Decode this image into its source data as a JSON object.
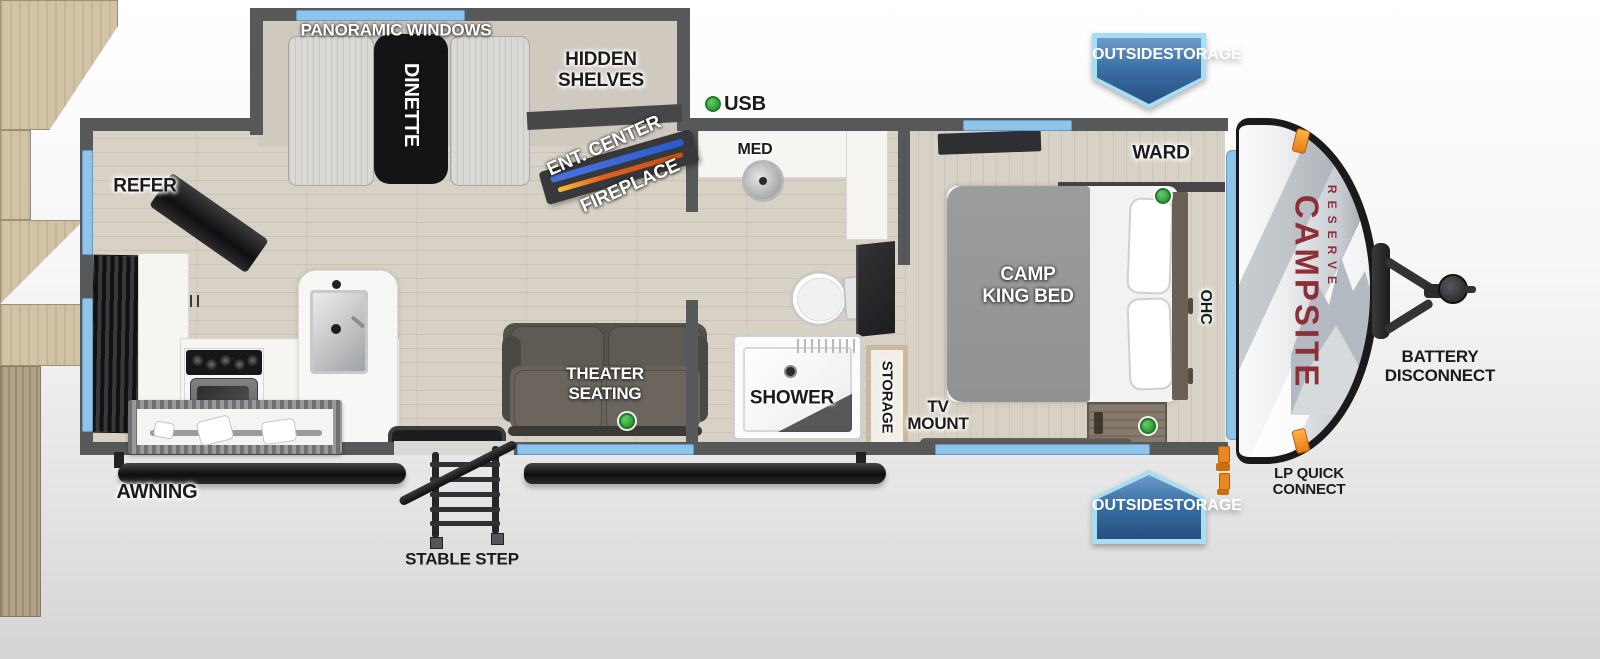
{
  "title": "Campsite Reserve travel trailer floorplan",
  "brand": {
    "line1": "CAMPSITE",
    "line2": "RESERVE"
  },
  "badges": {
    "top": [
      "OUTSIDE",
      "STORAGE"
    ],
    "bottom": [
      "OUTSIDE",
      "STORAGE"
    ]
  },
  "labels": {
    "panoramic_windows": "PANORAMIC WINDOWS",
    "dinette": "DINETTE",
    "hidden_shelves": [
      "HIDDEN",
      "SHELVES"
    ],
    "ent_center": "ENT. CENTER",
    "fireplace": "FIREPLACE",
    "usb": "USB",
    "med": "MED",
    "refer": "REFER",
    "ward": "WARD",
    "camp_king_bed": [
      "CAMP",
      "KING BED"
    ],
    "ohc": "OHC",
    "theater_seating": [
      "THEATER",
      "SEATING"
    ],
    "shower": "SHOWER",
    "storage": "STORAGE",
    "tv_mount": [
      "TV",
      "MOUNT"
    ],
    "battery_disconnect": [
      "BATTERY",
      "DISCONNECT"
    ],
    "lp_quick_connect": [
      "LP QUICK",
      "CONNECT"
    ],
    "awning": "AWNING",
    "stable_step": "STABLE STEP"
  },
  "colors": {
    "wall": "#57585a",
    "floor_wood": "#d8d1c5",
    "cabinet_wood": "#d2c3a6",
    "window_blue": "#8ec3ea",
    "badge_blue": "#2d5e92",
    "badge_border": "#a8ddf2",
    "brand_red": "#8c2f36",
    "usb_green": "#3fae49",
    "lp_orange": "#e8881e",
    "fireplace_blue": "#2a5ad0",
    "fireplace_flame": "#e2601c"
  }
}
